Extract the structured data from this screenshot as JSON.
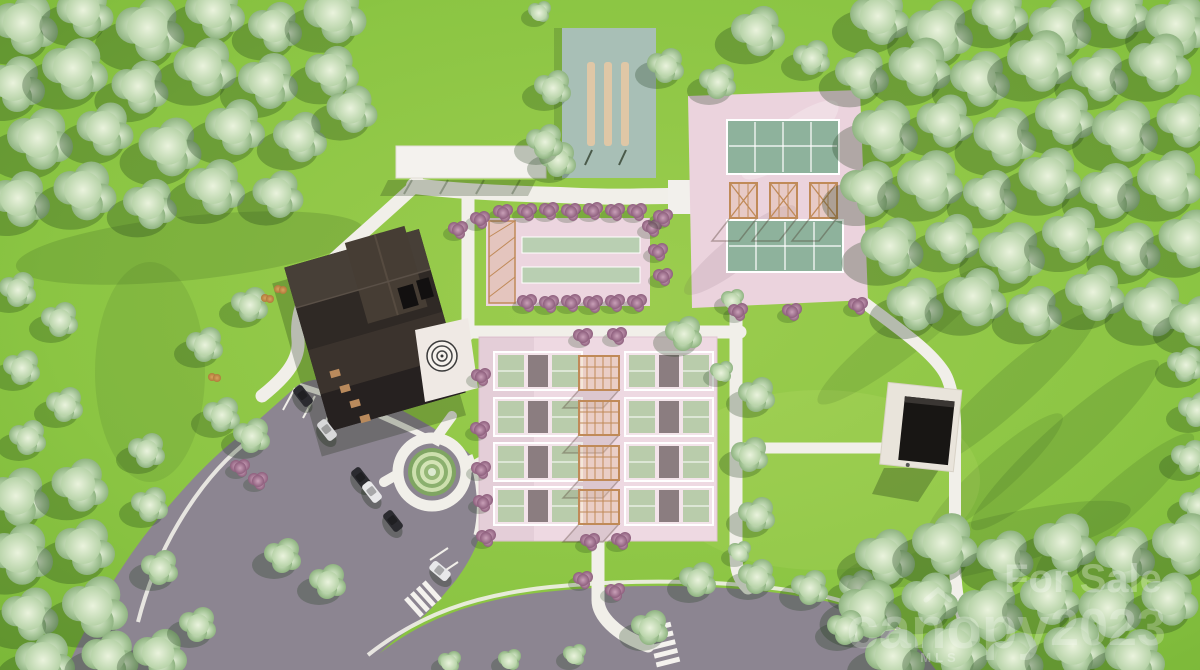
{
  "scene": {
    "type": "aerial-3d-site-plan-rendering",
    "subject": "Amenity campus rendering: clubhouse, parking lot, pickleball courts, tennis courts, bocce lanes, shuffleboard lanes, pergolas and surrounding forest",
    "counts": {
      "pickleball_courts": 8,
      "tennis_courts": 2,
      "bocce_lanes": 2,
      "shuffleboard_lanes": 3,
      "pergolas": 4,
      "practice_cages": 3,
      "cars_parked": 6
    }
  },
  "watermark": {
    "for_sale": "For Sale",
    "brand": "canopy",
    "brand_sub": "MLS",
    "year": "2023"
  },
  "palette": {
    "lawn": "#8bc543",
    "foliage": "#a9c89b",
    "court_pad_pink": "#eed9e2",
    "court_green": "#b9ccab",
    "tennis_green": "#8eb29c",
    "shuffleboard_teal": "#a8bfb6",
    "asphalt": "#8c8591",
    "path_white": "#f1efe9",
    "roof_dark": "#2a2522",
    "wood_tan": "#c08a58",
    "shrub_purple": "#9b6b85"
  }
}
